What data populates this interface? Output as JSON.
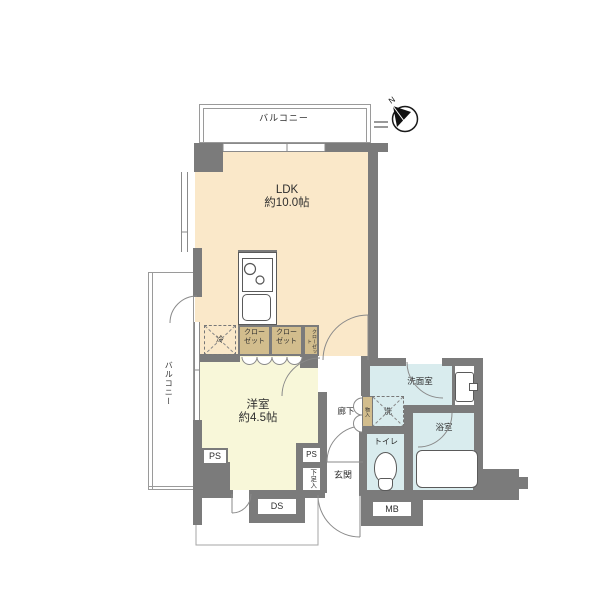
{
  "plan": {
    "title_hidden": "",
    "rooms": {
      "balcony_top": {
        "label": "バルコニー"
      },
      "balcony_left": {
        "label": "バルコニー"
      },
      "ldk": {
        "name": "LDK",
        "size": "約10.0帖"
      },
      "western": {
        "name": "洋室",
        "size": "約4.5帖"
      },
      "corridor": {
        "label": "廊下"
      },
      "entrance": {
        "label": "玄関"
      },
      "toilet": {
        "label": "トイレ"
      },
      "washroom": {
        "label": "洗面室"
      },
      "bathroom": {
        "label": "浴室"
      }
    },
    "fixtures": {
      "fridge": "冷",
      "laundry": "洗",
      "closet_a": "クローゼット",
      "closet_b": "クローゼット",
      "closet_c": "クローゼット",
      "storage": "物入",
      "shoe_box": "下足入"
    },
    "shafts": {
      "ps_left": "PS",
      "ps_right": "PS",
      "ds": "DS",
      "mb": "MB"
    },
    "compass": {
      "north": "N"
    },
    "colors": {
      "wall": "#7b7b7b",
      "ldk_floor": "#fae8c9",
      "western_floor": "#f8f7d9",
      "wet_floor": "#d9ecee",
      "closet": "#d2bd8d",
      "line": "#9a9a9a"
    }
  }
}
